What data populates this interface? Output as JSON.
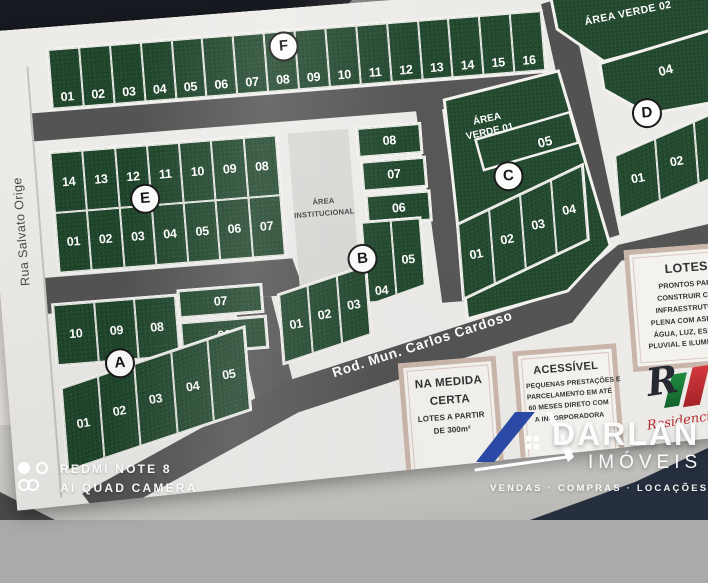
{
  "map": {
    "streets": {
      "left": "Rua Salvato Orige",
      "diagonal": "Rod. Mun. Carlos Cardoso"
    },
    "areas": {
      "institucional_l1": "ÁREA",
      "institucional_l2": "INSTITUCIONAL",
      "verde01_l1": "ÁREA",
      "verde01_l2": "VERDE 01",
      "verde02": "ÁREA VERDE 02"
    },
    "blocks": {
      "A": {
        "badge": "A",
        "top": [
          "10",
          "09",
          "08"
        ],
        "side": [
          "07",
          "06"
        ],
        "bottom": [
          "01",
          "02",
          "03",
          "04",
          "05"
        ]
      },
      "B": {
        "badge": "B",
        "stack": [
          "08",
          "07",
          "06"
        ],
        "mid": [
          "04",
          "05"
        ],
        "diag": [
          "01",
          "02",
          "03"
        ]
      },
      "C": {
        "badge": "C",
        "top": "05",
        "fan": [
          "01",
          "02",
          "03",
          "04"
        ]
      },
      "D": {
        "badge": "D",
        "top": "04",
        "fan": [
          "01",
          "02",
          "03"
        ]
      },
      "E": {
        "badge": "E",
        "top": [
          "14",
          "13",
          "12",
          "11",
          "10",
          "09",
          "08"
        ],
        "bottom": [
          "01",
          "02",
          "03",
          "04",
          "05",
          "06",
          "07"
        ]
      },
      "F": {
        "badge": "F",
        "lots": [
          "01",
          "02",
          "03",
          "04",
          "05",
          "06",
          "07",
          "08",
          "09",
          "10",
          "11",
          "12",
          "13",
          "14",
          "15",
          "16"
        ]
      }
    }
  },
  "info": {
    "lotes": {
      "title": "LOTES",
      "lines": [
        "PRONTOS PARA",
        "CONSTRUIR COM",
        "INFRAESTRUTURA",
        "PLENA COM ASFALTO",
        "ÁGUA, LUZ, ESGOTO",
        "PLUVIAL E ILUMINAÇÃO"
      ]
    },
    "medida": {
      "title_l1": "NA MEDIDA",
      "title_l2": "CERTA",
      "lines": [
        "LOTES A PARTIR",
        "DE 300m²"
      ]
    },
    "acessivel": {
      "title": "ACESSÍVEL",
      "lines": [
        "PEQUENAS PRESTAÇÕES E",
        "PARCELAMENTO EM ATÉ",
        "60 MESES DIRETO COM",
        "A INCORPORADORA"
      ]
    },
    "residencial": {
      "monogram": "R",
      "script": "Residencial"
    }
  },
  "watermarks": {
    "camera": {
      "line1": "REDMI NOTE 8",
      "line2": "AI QUAD CAMERA"
    },
    "agency": {
      "name": "DARLAN",
      "segment": "IMÓVEIS",
      "tagline": "VENDAS · COMPRAS · LOCAÇÕES"
    }
  },
  "colors": {
    "lot_green": "#21482d",
    "road_gray": "#545454",
    "paper": "#edebe8",
    "frame_tan": "#c9b4a8",
    "agency_blue": "#2b4aa5",
    "fabric_navy": "#252f3e"
  }
}
